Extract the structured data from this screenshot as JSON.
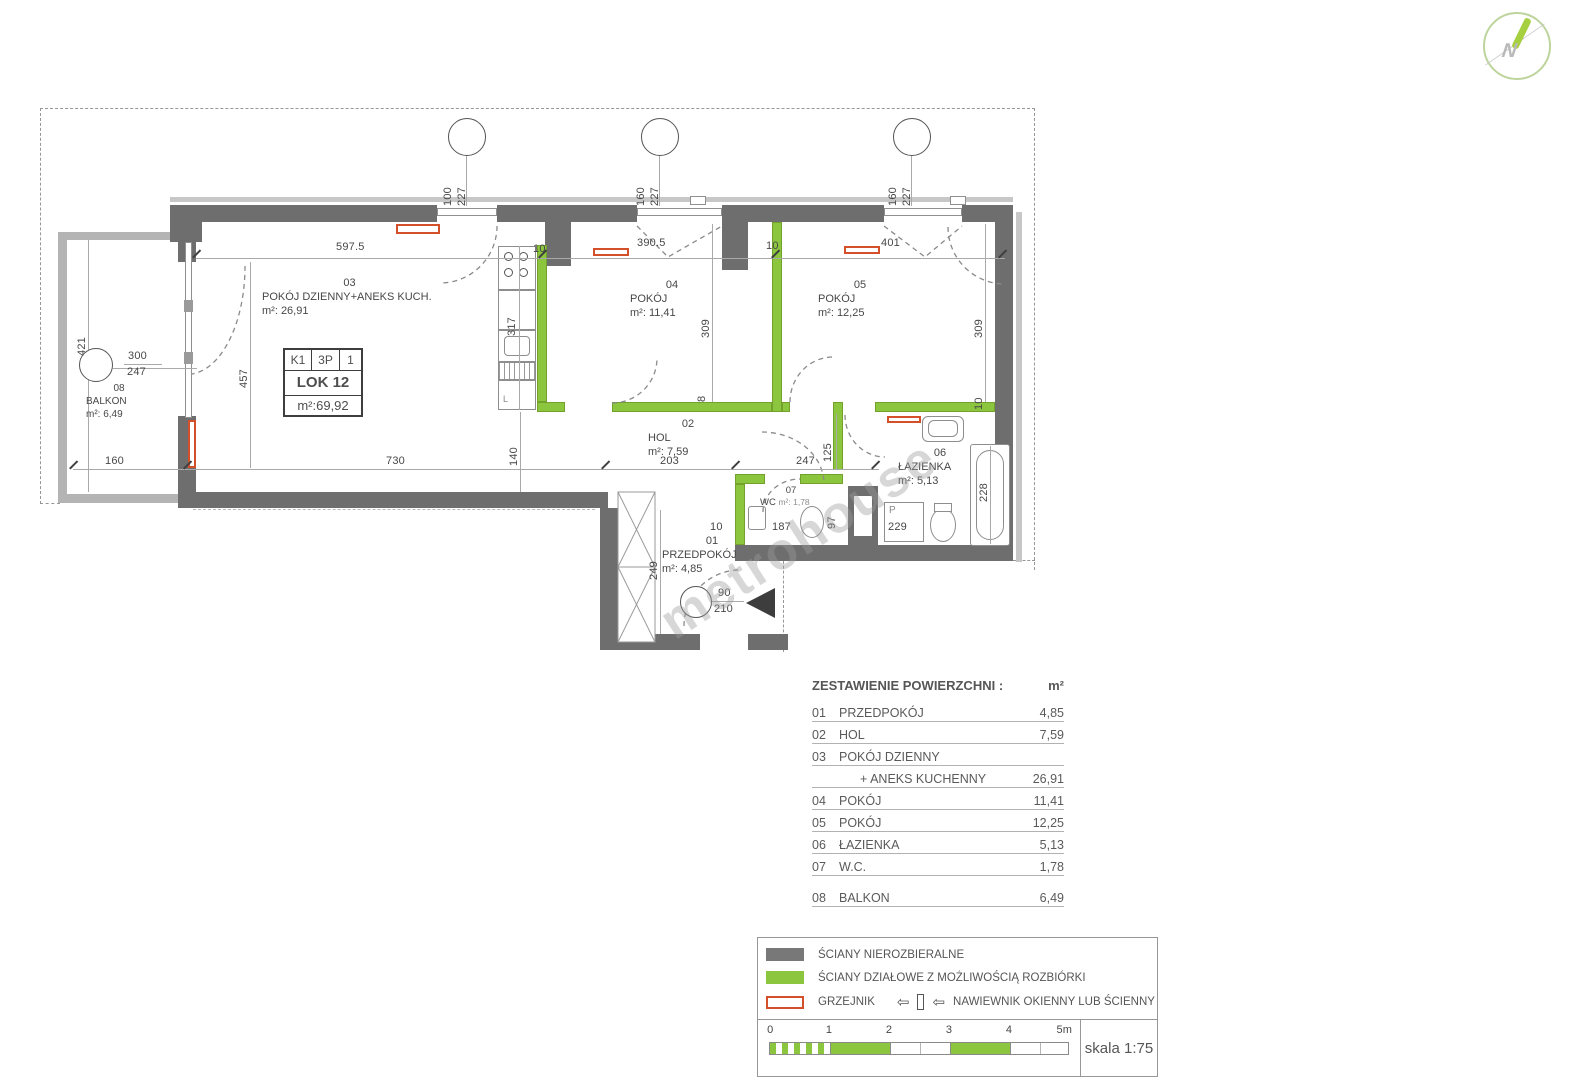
{
  "watermark": "metrohouse",
  "logo": {
    "letter": "N"
  },
  "unit_box": {
    "c1": "K1",
    "c2": "3P",
    "c3": "1",
    "name": "LOK 12",
    "area": "m²:69,92"
  },
  "rooms": [
    {
      "id": "03",
      "name": "POKÓJ DZIENNY+ANEKS KUCH.",
      "area": "m²: 26,91"
    },
    {
      "id": "04",
      "name": "POKÓJ",
      "area": "m²: 11,41"
    },
    {
      "id": "05",
      "name": "POKÓJ",
      "area": "m²: 12,25"
    },
    {
      "id": "02",
      "name": "HOL",
      "area": "m²: 7,59"
    },
    {
      "id": "06",
      "name": "ŁAZIENKA",
      "area": "m²: 5,13"
    },
    {
      "id": "07",
      "name": "WC",
      "area": "m²: 1,78"
    },
    {
      "id": "01",
      "name": "PRZEDPOKÓJ",
      "area": "m²: 4,85"
    },
    {
      "id": "08",
      "name": "BALKON",
      "area": "m²: 6,49"
    }
  ],
  "fixtures": {
    "washing_machine": "P",
    "fridge": "L"
  },
  "dims": [
    "597.5",
    "390.5",
    "401",
    "10",
    "10",
    "100",
    "227",
    "160",
    "227",
    "160",
    "227",
    "421",
    "300",
    "247",
    "160",
    "457",
    "317",
    "309",
    "309",
    "8",
    "10",
    "730",
    "140",
    "203",
    "247",
    "125",
    "97",
    "187",
    "229",
    "228",
    "10",
    "249",
    "90",
    "210"
  ],
  "table": {
    "title": "ZESTAWIENIE POWIERZCHNI :",
    "unit": "m²",
    "rows": [
      {
        "no": "01",
        "name": "PRZEDPOKÓJ",
        "value": "4,85"
      },
      {
        "no": "02",
        "name": "HOL",
        "value": "7,59"
      },
      {
        "no": "03",
        "name": "POKÓJ DZIENNY",
        "value": ""
      },
      {
        "no": "",
        "name": "+ ANEKS KUCHENNY",
        "value": "26,91"
      },
      {
        "no": "04",
        "name": "POKÓJ",
        "value": "11,41"
      },
      {
        "no": "05",
        "name": "POKÓJ",
        "value": "12,25"
      },
      {
        "no": "06",
        "name": "ŁAZIENKA",
        "value": "5,13"
      },
      {
        "no": "07",
        "name": "W.C.",
        "value": "1,78"
      },
      {
        "no": "08",
        "name": "BALKON",
        "value": "6,49"
      }
    ]
  },
  "legend": {
    "wall_solid": "ŚCIANY NIEROZBIERALNE",
    "wall_green": "ŚCIANY DZIAŁOWE Z MOŻLIWOŚCIĄ ROZBIÓRKI",
    "radiator": "GRZEJNIK",
    "vent": "NAWIEWNIK OKIENNY LUB ŚCIENNY",
    "scale": "skala 1:75",
    "ticks": [
      "0",
      "1",
      "2",
      "3",
      "4",
      "5m"
    ]
  },
  "colors": {
    "wall": "#6e6e6e",
    "partition": "#8cc63e",
    "radiator": "#d4502a"
  }
}
